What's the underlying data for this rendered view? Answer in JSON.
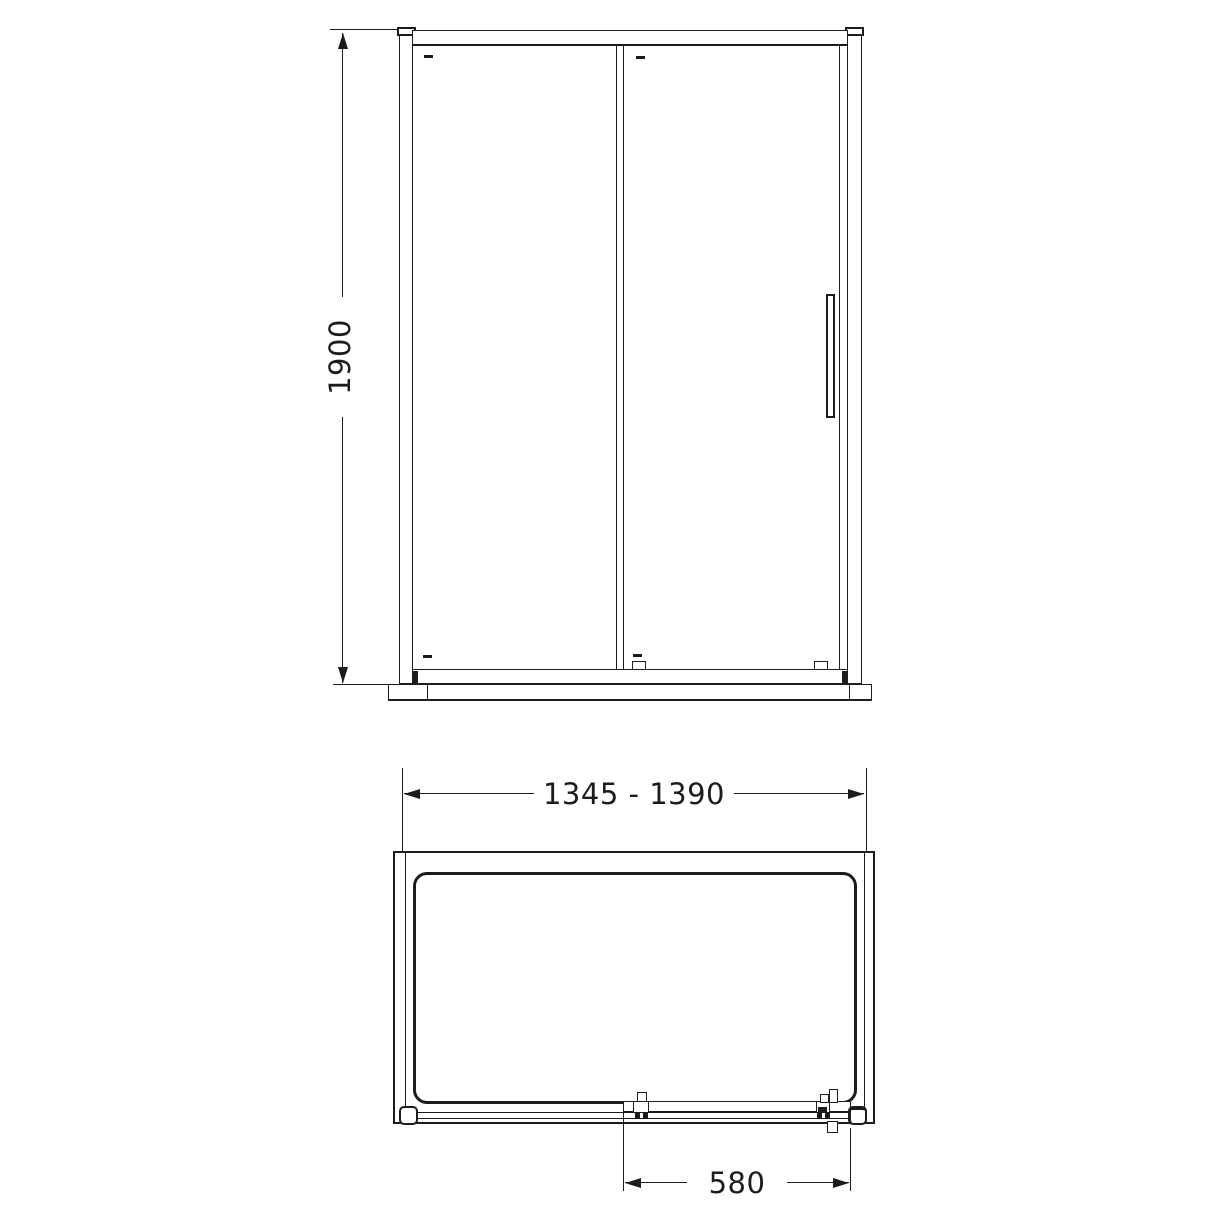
{
  "colors": {
    "line": "#1c1c1c",
    "background": "#ffffff"
  },
  "front_view": {
    "height_dimension": "1900"
  },
  "plan_view": {
    "width_dimension": "1345 - 1390",
    "opening_dimension": "580"
  }
}
